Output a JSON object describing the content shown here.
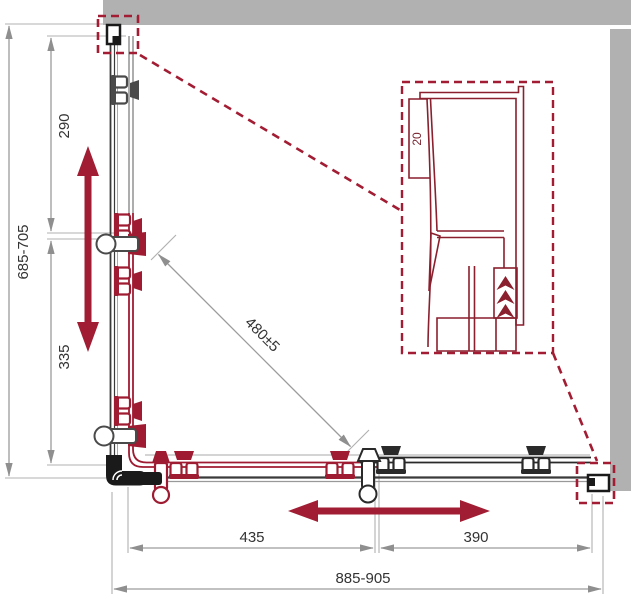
{
  "labels": {
    "left_total": "685-705",
    "left_upper": "290",
    "left_lower": "335",
    "diagonal": "480±5",
    "bottom_left": "435",
    "bottom_right": "390",
    "bottom_total": "885-905",
    "detail_gap": "20"
  },
  "colors": {
    "accent_red": "#9e1b31",
    "arrow_red": "#a01d33",
    "detail_red": "#8a1f2d",
    "callout_dash_red": "#a21d33",
    "wall_gray": "#b1b1b1",
    "dimension_gray": "#9c9c9c",
    "line_dark": "#2a2a2a"
  }
}
